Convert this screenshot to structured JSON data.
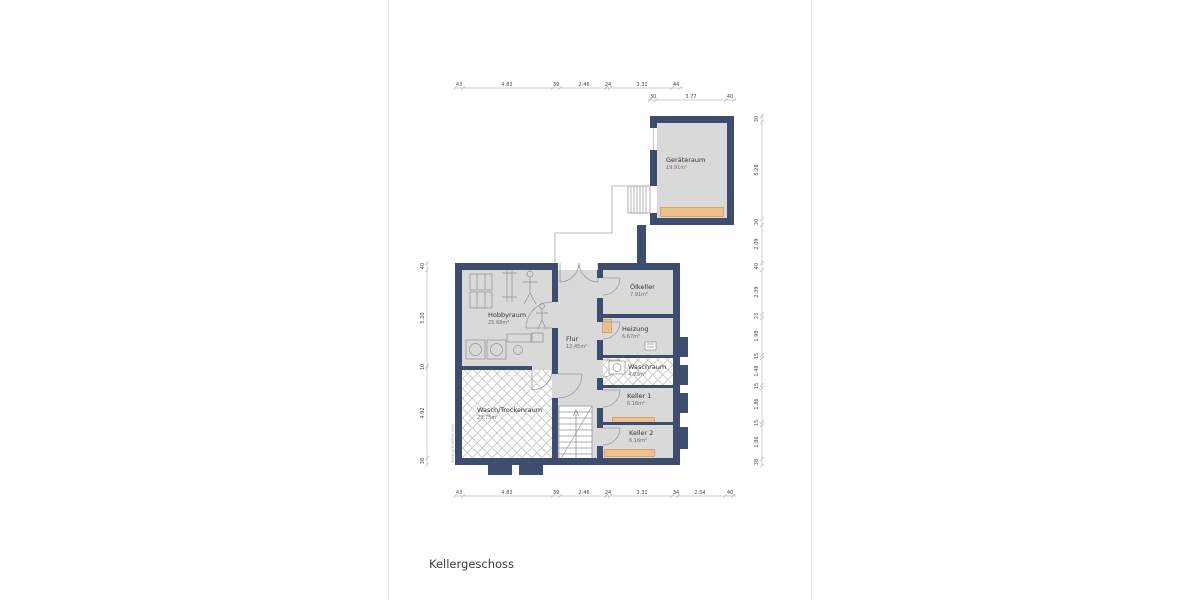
{
  "title": "Kellergeschoss",
  "watermark": "www.grundriss.com",
  "rooms": {
    "geraeteraum": {
      "name": "Geräteraum",
      "area": "19.91m²"
    },
    "hobbyraum": {
      "name": "Hobbyraum",
      "area": "25.68m²"
    },
    "flur": {
      "name": "Flur",
      "area": "12.45m²"
    },
    "oelkeller": {
      "name": "Ölkeller",
      "area": "7.91m²"
    },
    "heizung": {
      "name": "Heizung",
      "area": "6.67m²"
    },
    "waschraum": {
      "name": "Waschraum",
      "area": "4.93m²"
    },
    "keller1": {
      "name": "Keller 1",
      "area": "6.16m²"
    },
    "keller2": {
      "name": "Keller 2",
      "area": "6.16m²"
    },
    "waschtrockenraum": {
      "name": "Wasch/Trockenraum",
      "area": "23.75m²"
    }
  },
  "dimensions": {
    "top_main": [
      "43",
      "4.83",
      "39",
      "2.46",
      "24",
      "3.31",
      "44"
    ],
    "top_annex": [
      "30",
      "3.77",
      "40"
    ],
    "bottom": [
      "43",
      "4.83",
      "39",
      "2.46",
      "24",
      "3.31",
      "34",
      "2.54",
      "40"
    ],
    "left": [
      "40",
      "5.20",
      "10",
      "4.92",
      "38"
    ],
    "right": [
      "30",
      "5.28",
      "30",
      "2.09",
      "40",
      "2.39",
      "23",
      "1.98",
      "15",
      "1.48",
      "15",
      "1.86",
      "15",
      "1.86",
      "38"
    ]
  },
  "colors": {
    "wall": "#3e4d6e",
    "floor": "#d9d9d9",
    "accent": "#eec08d"
  }
}
